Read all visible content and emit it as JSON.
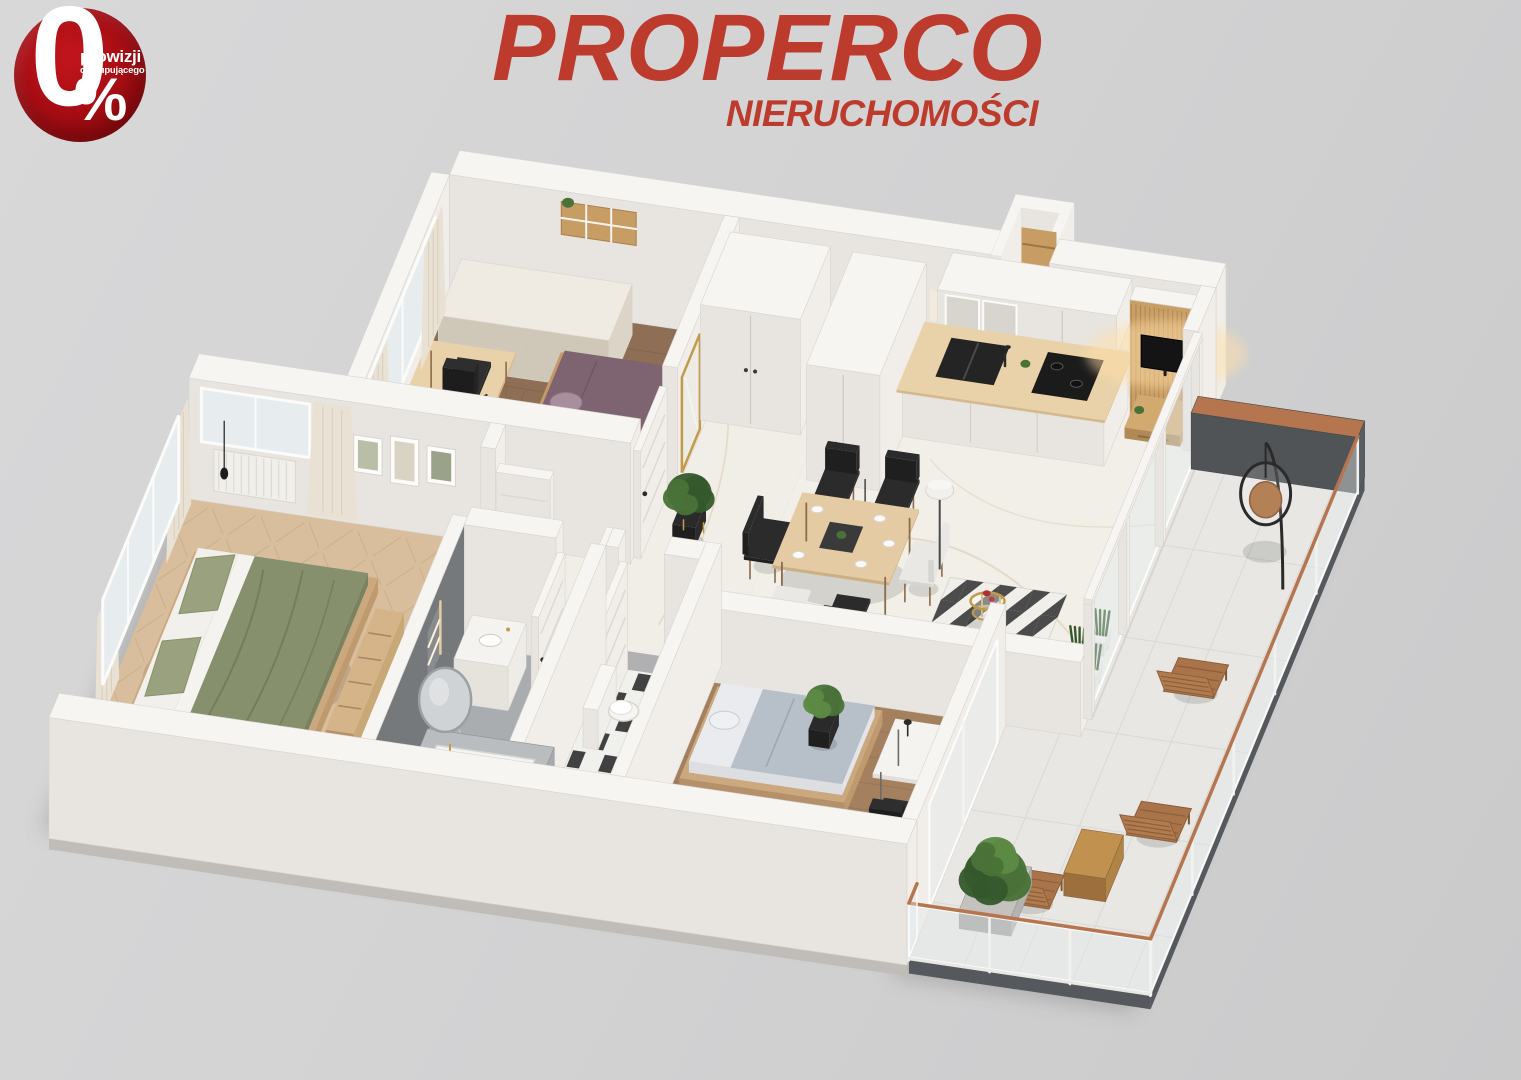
{
  "page": {
    "background_top": "#d8d8d9",
    "background_bottom": "#cacacb"
  },
  "badge": {
    "value": "0",
    "percent_sign": "%",
    "line1": "prowizji",
    "line2": "od kupującego",
    "color_center": "#c2151c",
    "color_mid": "#a60d13",
    "color_edge": "#8a070d",
    "text_color": "#ffffff"
  },
  "logo": {
    "name": "PROPERCO",
    "subtitle": "NIERUCHOMOŚCI",
    "color": "#bd3b2d"
  },
  "scene": {
    "alt": "3D isometric cutaway render of a furnished apartment floor plan with a wrap balcony",
    "rooms": [
      "master-bedroom",
      "office-bedroom",
      "hallway",
      "bathroom",
      "wc",
      "kitchen",
      "living-dining",
      "bedroom-3",
      "balcony"
    ]
  },
  "palette": {
    "wallTop": "#f7f5f2",
    "wallS": "#e8e4df",
    "wallE": "#f1eee9",
    "wallLine": "#d8d4cf",
    "bathWall": "#75797c",
    "bathWallDark": "#63676a",
    "floorMarble": "#f2efe9",
    "floorHall": "#f1eee8",
    "vein": "#d7c6a6",
    "vein2": "#c9b48e",
    "oak": "#d8be9c",
    "oakLine": "#c2a37c",
    "walnut": "#8e6f55",
    "walnutLine": "#7a5c44",
    "wood3": "#a4805f",
    "wood3Line": "#8d6b4c",
    "bathFloor": "#a9adaf",
    "bathVein": "#cdd1d3",
    "tileB": "#2e2e2f",
    "tileW": "#f0f0ed",
    "balconyFloor": "#e8e7e4",
    "balconyLine": "#d8d7d4",
    "cab": "#e9e5de",
    "cabLine": "#cfc9c0",
    "counter": "#e9d2a9",
    "splash": "#f2eadc",
    "slat": "#c99f66",
    "slatLine": "#a87f4e",
    "tv": "#141414",
    "glow": "#ffdfa8",
    "woodWarm": "#c79d63",
    "tan": "#c49e68",
    "dresser": "#cfc7b8",
    "greenDuvet": "#86906c",
    "greenFold": "#6f7857",
    "greenPillow": "#9aa17e",
    "mauve": "#7e6371",
    "mauvePillow": "#a98f9e",
    "bed3": "#b7c0c8",
    "bed3Side": "#e9ebee",
    "frameWood": "#cba87e",
    "curtain": "#e9e2d4",
    "curtainFold": "#d8cfbc",
    "win": "#e7edef",
    "glass": "rgba(226,234,237,0.42)",
    "glassStroke": "rgba(255,255,255,0.85)",
    "white": "#f4f3f0",
    "black": "#232323",
    "chairB": "#2b2b2b",
    "chairW": "#e9e8e5",
    "gold": "#c29b4a",
    "copper": "#b5764f",
    "parapet": "#595c60",
    "plinthDark": "#55585c",
    "plinth": "#c0bcb8",
    "green1": "#4a7238",
    "green2": "#35592c",
    "green3": "#5c8a45",
    "potBlack": "#1f1f1f",
    "potWhite": "#eceae6",
    "shadow": "rgba(0,0,0,0.12)"
  }
}
